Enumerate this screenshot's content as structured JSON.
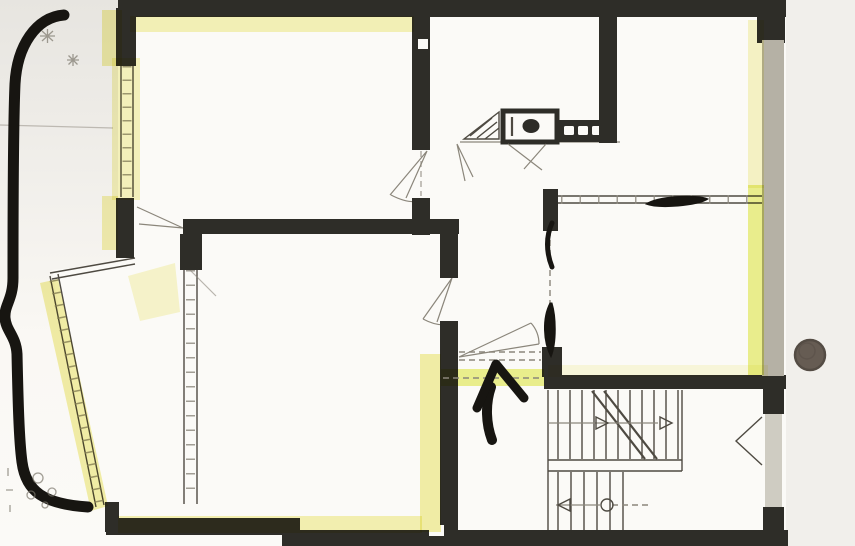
{
  "document": {
    "kind": "scanned-floor-plan",
    "title": "Hand-annotated apartment floor plan scan"
  },
  "colors": {
    "wall": "#2e2d28",
    "wall_mid": "#b5b1a5",
    "wall_light": "#cfccc2",
    "pencil": "#4e4a42",
    "pencil_light": "#8b867b",
    "paper": "#fbfaf7",
    "bg_left_top": "#e7e5e0",
    "bg_left_bottom": "#faf8f4",
    "bg_right": "#f1efeb",
    "highlight": "#f2ee96",
    "highlight_strong": "#eaf07e",
    "marker": "#171511",
    "doodle": "#7a766b",
    "dot": "#665c53",
    "dot_ring": "#544c44"
  },
  "annotations": {
    "marker_curve_left": "thick marker curve along left margin",
    "pencil_stars": "pencil asterisks top-left margin",
    "marker_line_window": "marker stroke over top wall of right room",
    "marker_tick_upper": "marker tick on hallway partition",
    "marker_tick_lower": "marker blob at hallway door",
    "entrance_arrow": "marker arrow pointing up at entrance",
    "hole_punch_dot": "round brown dot in right margin",
    "pencil_doodles": "faint pencil doodles bottom-left margin",
    "stair_up_label": "stair direction arrows"
  }
}
